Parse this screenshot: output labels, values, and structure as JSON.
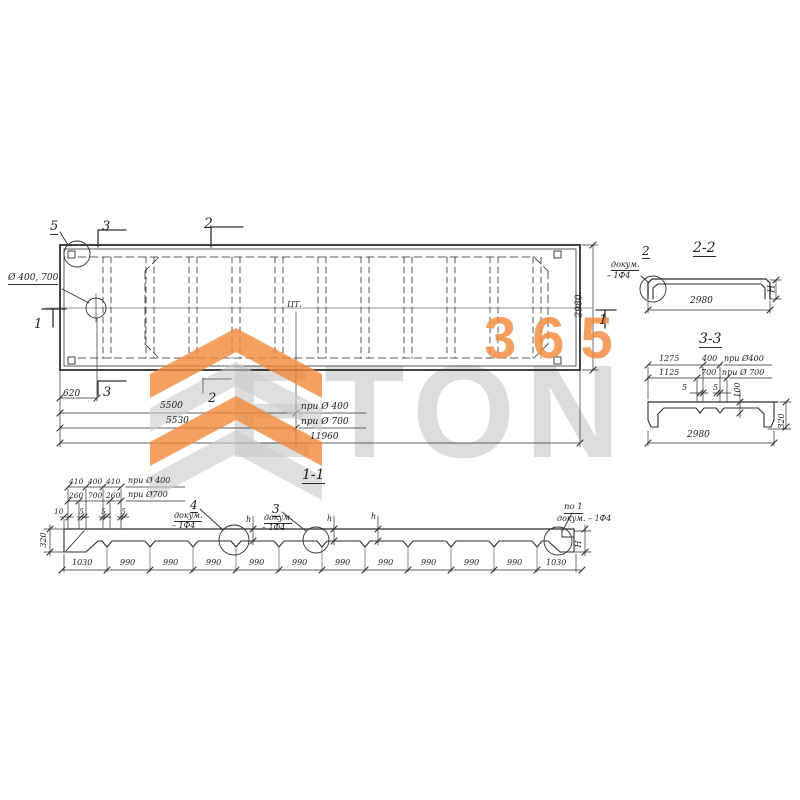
{
  "watermark": {
    "word": "ETON",
    "number": "365",
    "orange": "#f0883a",
    "gray": "#c9c9c9"
  },
  "labels": [
    {
      "name": "detail-5-label",
      "text": "5",
      "x": 50,
      "y": 220,
      "s": 13,
      "u": 1
    },
    {
      "name": "cut-3-top-label",
      "text": "3",
      "x": 102,
      "y": 220,
      "s": 13
    },
    {
      "name": "cut-2-top-label",
      "text": "2",
      "x": 204,
      "y": 217,
      "s": 14
    },
    {
      "name": "hole-diameter-label",
      "text": "Ø 400, 700",
      "x": 8,
      "y": 274,
      "s": 9,
      "u": 1
    },
    {
      "name": "cut-1-left-label",
      "text": "1",
      "x": 34,
      "y": 318,
      "s": 13
    },
    {
      "name": "center-of-gravity-label",
      "text": "ЦТ.",
      "x": 287,
      "y": 301,
      "s": 8
    },
    {
      "name": "plan-width-dim",
      "text": "2980",
      "x": 580,
      "y": 306,
      "s": 9,
      "rot": -90
    },
    {
      "name": "cut-1-right-label",
      "text": "1",
      "x": 599,
      "y": 314,
      "s": 13
    },
    {
      "name": "dim-620",
      "text": "620",
      "x": 63,
      "y": 390,
      "s": 9
    },
    {
      "name": "cut-3-bottom-label",
      "text": "3",
      "x": 103,
      "y": 386,
      "s": 13
    },
    {
      "name": "cut-2-bottom-label",
      "text": "2",
      "x": 208,
      "y": 392,
      "s": 13
    },
    {
      "name": "dim-5500",
      "text": "5500",
      "x": 160,
      "y": 402,
      "s": 9
    },
    {
      "name": "note-at-dia-400",
      "text": "при Ø 400",
      "x": 301,
      "y": 403,
      "s": 9
    },
    {
      "name": "dim-5530",
      "text": "5530",
      "x": 166,
      "y": 417,
      "s": 9
    },
    {
      "name": "note-at-dia-700",
      "text": "при Ø 700",
      "x": 301,
      "y": 418,
      "s": 9
    },
    {
      "name": "dim-11960",
      "text": "11960",
      "x": 310,
      "y": 433,
      "s": 9
    },
    {
      "name": "section-2-2-title",
      "text": "2-2",
      "x": 693,
      "y": 241,
      "s": 14,
      "u": 1
    },
    {
      "name": "detail-2-label",
      "text": "2",
      "x": 642,
      "y": 245,
      "s": 12,
      "u": 1
    },
    {
      "name": "detail-2-note-1",
      "text": "докум.",
      "x": 611,
      "y": 261,
      "s": 8,
      "u": 1
    },
    {
      "name": "detail-2-note-2",
      "text": "– 1Ф4",
      "x": 607,
      "y": 272,
      "s": 8
    },
    {
      "name": "dim-2980-section-2-2",
      "text": "2980",
      "x": 690,
      "y": 297,
      "s": 9
    },
    {
      "name": "dim-H-section-2-2",
      "text": "H",
      "x": 773,
      "y": 289,
      "s": 9,
      "rot": -90
    },
    {
      "name": "section-3-3-title",
      "text": "3-3",
      "x": 699,
      "y": 332,
      "s": 14,
      "u": 1
    },
    {
      "name": "dim-1275",
      "text": "1275",
      "x": 659,
      "y": 355,
      "s": 8
    },
    {
      "name": "dim-400-s33",
      "text": "400",
      "x": 702,
      "y": 355,
      "s": 8
    },
    {
      "name": "note-400-s33",
      "text": "при Ø400",
      "x": 724,
      "y": 355,
      "s": 8
    },
    {
      "name": "dim-1125",
      "text": "1125",
      "x": 659,
      "y": 369,
      "s": 8
    },
    {
      "name": "dim-700-s33",
      "text": "700",
      "x": 701,
      "y": 369,
      "s": 8
    },
    {
      "name": "note-700-s33",
      "text": "при Ø 700",
      "x": 722,
      "y": 369,
      "s": 8
    },
    {
      "name": "dim-5-s33-a",
      "text": "5",
      "x": 682,
      "y": 384,
      "s": 8
    },
    {
      "name": "dim-5-s33-b",
      "text": "5",
      "x": 713,
      "y": 384,
      "s": 8
    },
    {
      "name": "dim-100-s33",
      "text": "100",
      "x": 738,
      "y": 390,
      "s": 8,
      "rot": -90
    },
    {
      "name": "dim-320-s33",
      "text": "320",
      "x": 782,
      "y": 421,
      "s": 8,
      "rot": -90
    },
    {
      "name": "dim-2980-s33",
      "text": "2980",
      "x": 687,
      "y": 431,
      "s": 9
    },
    {
      "name": "section-1-1-title",
      "text": "1-1",
      "x": 302,
      "y": 468,
      "s": 14,
      "u": 1
    },
    {
      "name": "dim-410-a",
      "text": "410",
      "x": 69,
      "y": 478,
      "s": 7.5
    },
    {
      "name": "dim-400-s11",
      "text": "400",
      "x": 88,
      "y": 478,
      "s": 7.5
    },
    {
      "name": "dim-410-b",
      "text": "410",
      "x": 106,
      "y": 478,
      "s": 7.5
    },
    {
      "name": "note-400-s11",
      "text": "при Ø 400",
      "x": 128,
      "y": 477,
      "s": 8
    },
    {
      "name": "dim-260-a",
      "text": "260",
      "x": 69,
      "y": 492,
      "s": 7.5
    },
    {
      "name": "dim-700-s11",
      "text": "700",
      "x": 88,
      "y": 492,
      "s": 7.5
    },
    {
      "name": "dim-260-b",
      "text": "260",
      "x": 106,
      "y": 492,
      "s": 7.5
    },
    {
      "name": "note-700-s11",
      "text": "при Ø700",
      "x": 128,
      "y": 491,
      "s": 8
    },
    {
      "name": "dim-10",
      "text": "10",
      "x": 54,
      "y": 508,
      "s": 7.5
    },
    {
      "name": "dim-5-a",
      "text": "5",
      "x": 79,
      "y": 508,
      "s": 7.5
    },
    {
      "name": "dim-5-b",
      "text": "5",
      "x": 101,
      "y": 508,
      "s": 7.5
    },
    {
      "name": "dim-5-c",
      "text": "5",
      "x": 121,
      "y": 508,
      "s": 7.5
    },
    {
      "name": "detail-4-label",
      "text": "4",
      "x": 190,
      "y": 499,
      "s": 12,
      "u": 1
    },
    {
      "name": "detail-4-note-1",
      "text": "докум.",
      "x": 174,
      "y": 512,
      "s": 8,
      "u": 1
    },
    {
      "name": "detail-4-note-2",
      "text": "– 1Ф4",
      "x": 172,
      "y": 522,
      "s": 8
    },
    {
      "name": "detail-3-label",
      "text": "3",
      "x": 272,
      "y": 503,
      "s": 12,
      "u": 1
    },
    {
      "name": "detail-3-note-1",
      "text": "докум.",
      "x": 264,
      "y": 514,
      "s": 8,
      "u": 1
    },
    {
      "name": "detail-3-note-2",
      "text": "– 1Ф4",
      "x": 262,
      "y": 524,
      "s": 8
    },
    {
      "name": "dim-h-1",
      "text": "h",
      "x": 246,
      "y": 516,
      "s": 8
    },
    {
      "name": "dim-h-2",
      "text": "h",
      "x": 327,
      "y": 515,
      "s": 8
    },
    {
      "name": "dim-h-3",
      "text": "h",
      "x": 371,
      "y": 513,
      "s": 8
    },
    {
      "name": "note-po-1",
      "text": "по 1",
      "x": 564,
      "y": 503,
      "s": 8.5,
      "u": 1
    },
    {
      "name": "note-po-1-docum",
      "text": "докум. – 1Ф4",
      "x": 557,
      "y": 515,
      "s": 8
    },
    {
      "name": "dim-H-s11",
      "text": "H",
      "x": 579,
      "y": 544,
      "s": 8,
      "rot": -90
    },
    {
      "name": "dim-320-s11",
      "text": "320",
      "x": 44,
      "y": 540,
      "s": 8,
      "rot": -90
    },
    {
      "name": "seg-1030-a",
      "text": "1030",
      "x": 72,
      "y": 559,
      "s": 8
    },
    {
      "name": "seg-990-1",
      "text": "990",
      "x": 120,
      "y": 559,
      "s": 8
    },
    {
      "name": "seg-990-2",
      "text": "990",
      "x": 163,
      "y": 559,
      "s": 8
    },
    {
      "name": "seg-990-3",
      "text": "990",
      "x": 206,
      "y": 559,
      "s": 8
    },
    {
      "name": "seg-990-4",
      "text": "990",
      "x": 249,
      "y": 559,
      "s": 8
    },
    {
      "name": "seg-990-5",
      "text": "990",
      "x": 292,
      "y": 559,
      "s": 8
    },
    {
      "name": "seg-990-6",
      "text": "990",
      "x": 335,
      "y": 559,
      "s": 8
    },
    {
      "name": "seg-990-7",
      "text": "990",
      "x": 378,
      "y": 559,
      "s": 8
    },
    {
      "name": "seg-990-8",
      "text": "990",
      "x": 421,
      "y": 559,
      "s": 8
    },
    {
      "name": "seg-990-9",
      "text": "990",
      "x": 464,
      "y": 559,
      "s": 8
    },
    {
      "name": "seg-990-10",
      "text": "990",
      "x": 507,
      "y": 559,
      "s": 8
    },
    {
      "name": "seg-1030-b",
      "text": "1030",
      "x": 546,
      "y": 559,
      "s": 8
    }
  ]
}
